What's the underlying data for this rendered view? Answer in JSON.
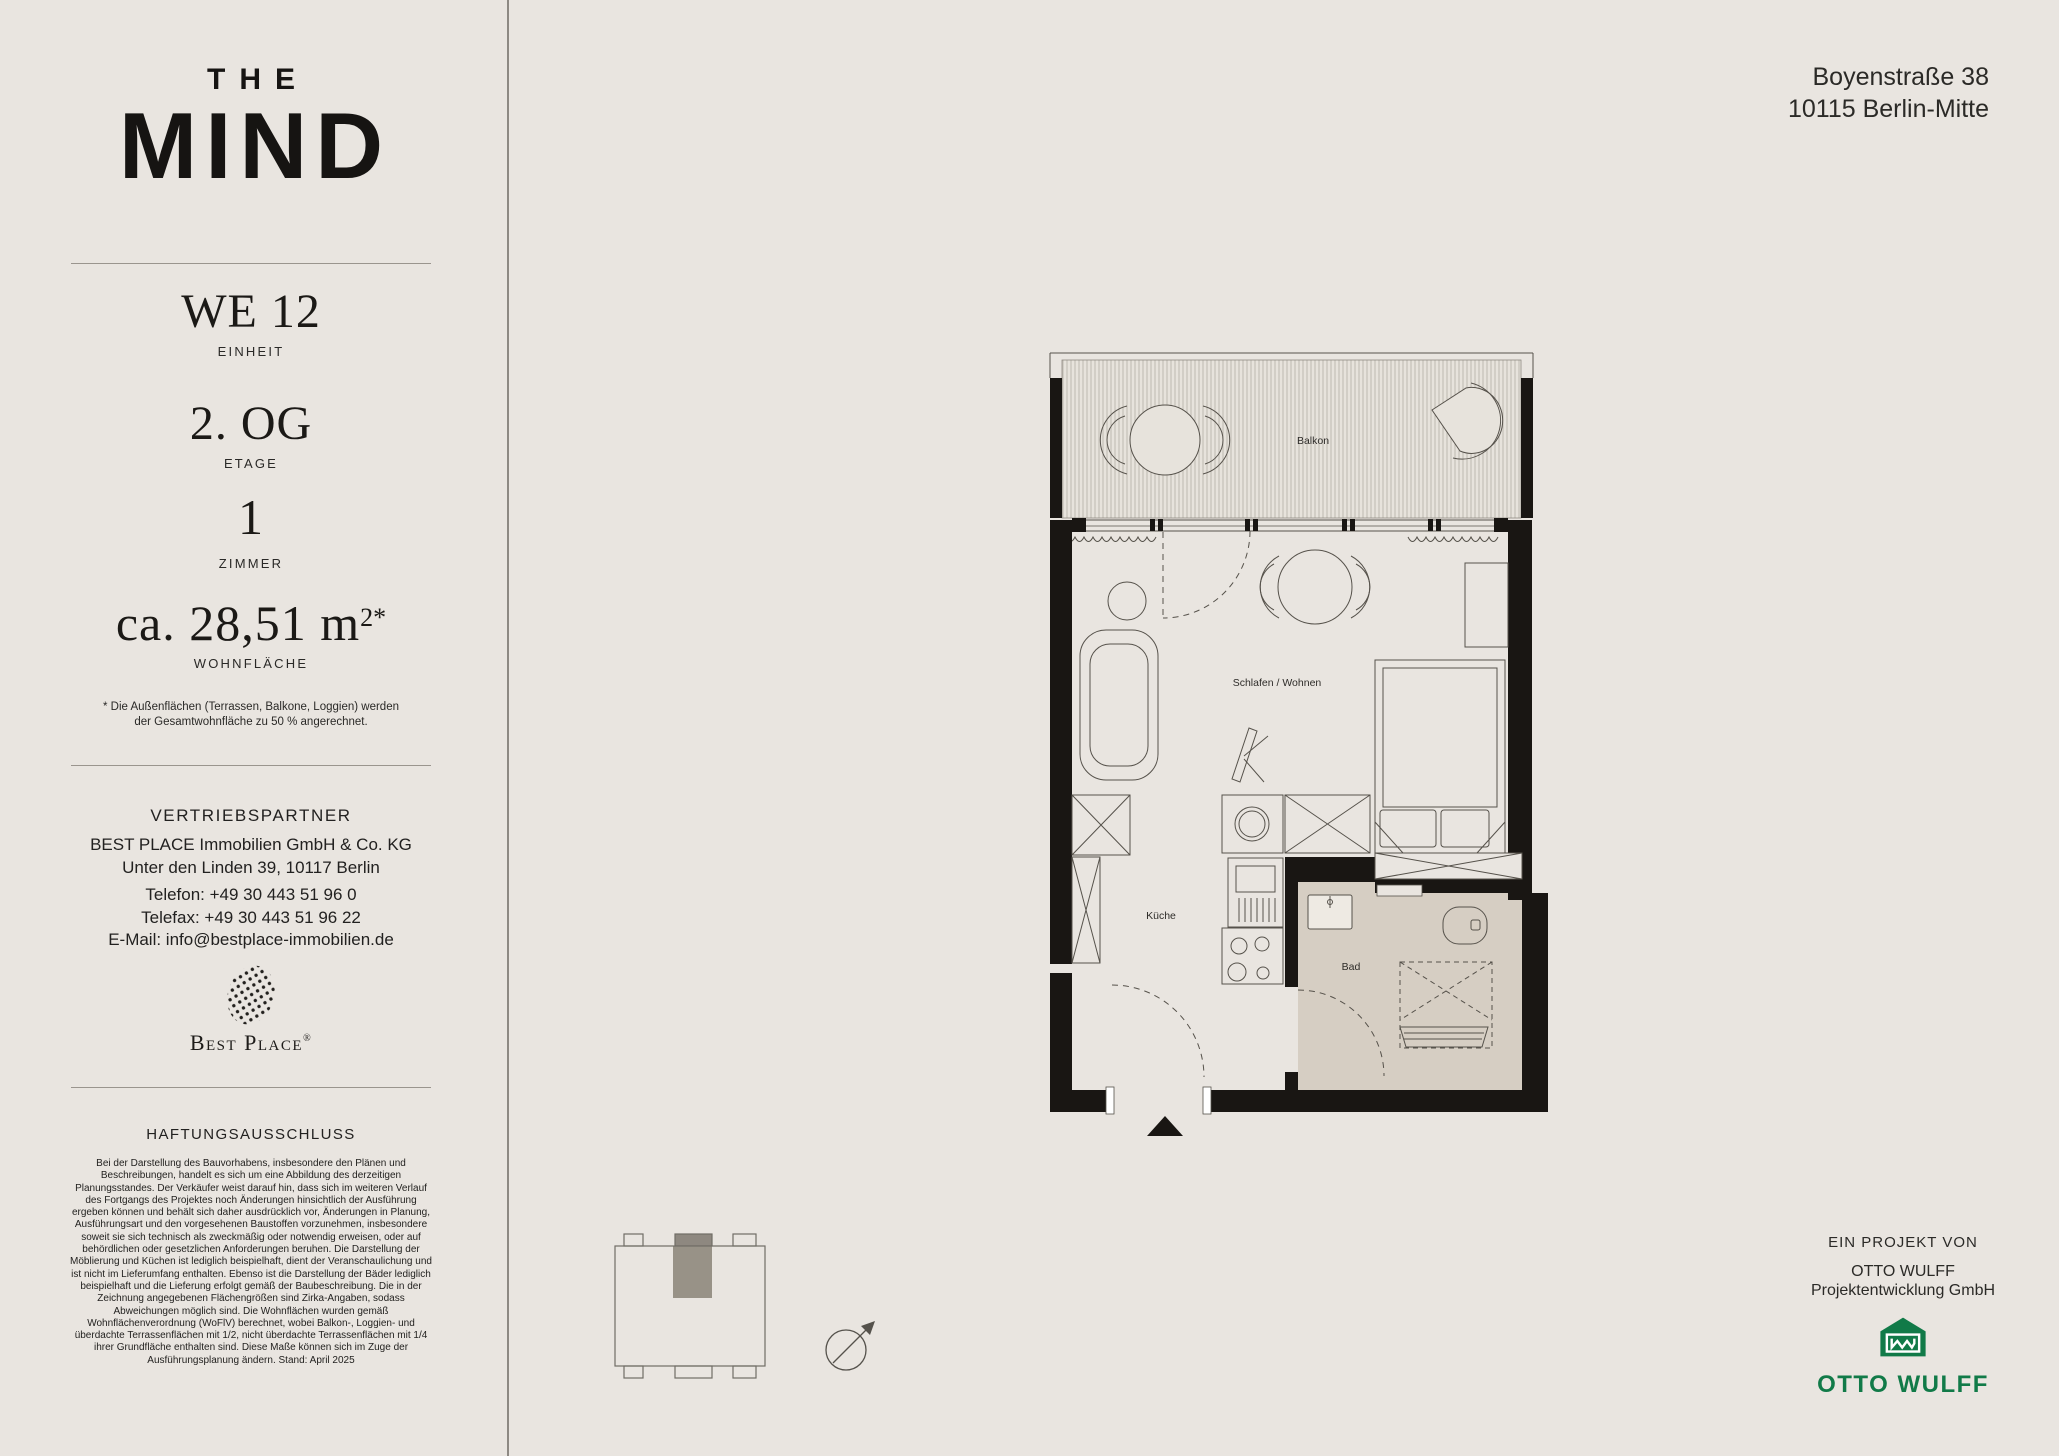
{
  "brand": {
    "line1": "THE",
    "line2": "MIND"
  },
  "sidebar": {
    "unit": {
      "value": "WE 12",
      "label": "EINHEIT"
    },
    "floor": {
      "value": "2. OG",
      "label": "ETAGE"
    },
    "rooms": {
      "value": "1",
      "label": "ZIMMER"
    },
    "area": {
      "value": "ca. 28,51 m",
      "sup": "2*",
      "label": "WOHNFLÄCHE"
    },
    "footnote": "* Die Außenflächen (Terrassen, Balkone, Loggien) werden der Gesamtwohnfläche zu 50 % angerechnet.",
    "partner": {
      "heading": "VERTRIEBSPARTNER",
      "name": "BEST PLACE Immobilien GmbH & Co. KG",
      "address": "Unter den Linden 39, 10117 Berlin",
      "phone": "Telefon: +49 30 443 51 96 0",
      "fax": "Telefax: +49 30 443 51 96 22",
      "email": "E-Mail: info@bestplace-immobilien.de",
      "logo_wordmark": "Best Place",
      "logo_registered": "®"
    },
    "disclaimer": {
      "heading": "HAFTUNGSAUSSCHLUSS",
      "text": "Bei der Darstellung des Bauvorhabens, insbesondere den Plänen und Beschreibungen, handelt es sich um eine Abbildung des derzeitigen Planungsstandes. Der Verkäufer weist darauf hin, dass sich im weiteren Verlauf des Fortgangs des Projektes noch Änderungen hinsichtlich der Ausführung ergeben können und behält sich daher ausdrücklich vor, Änderungen in Planung, Ausführungsart und den vorgesehenen Baustoffen vorzunehmen, insbesondere soweit sie sich technisch als zweckmäßig oder notwendig erweisen, oder auf behördlichen oder gesetzlichen Anforderungen beruhen. Die Darstellung der Möblierung und Küchen ist lediglich beispielhaft, dient der Veranschaulichung und ist nicht im Lieferumfang enthalten. Ebenso ist die Darstellung der Bäder lediglich beispielhaft und die Lieferung erfolgt gemäß der Baubeschreibung. Die in der Zeichnung angegebenen Flächengrößen sind Zirka-Angaben, sodass Abweichungen möglich sind. Die Wohnflächen wurden gemäß Wohnflächenverordnung (WoFlV) berechnet, wobei Balkon-, Loggien- und überdachte Terrassenflächen mit 1/2, nicht überdachte Terrassenflächen mit 1/4 ihrer Grundfläche enthalten sind. Diese Maße können sich im Zuge der Ausführungsplanung ändern. Stand: April 2025"
    }
  },
  "header": {
    "address_line1": "Boyenstraße 38",
    "address_line2": "10115 Berlin-Mitte"
  },
  "project": {
    "heading": "EIN PROJEKT VON",
    "company_line1": "OTTO WULFF",
    "company_line2": "Projektentwicklung GmbH",
    "logo_wordmark": "OTTO WULFF",
    "brand_green": "#117a48"
  },
  "floorplan": {
    "labels": {
      "balcony": "Balkon",
      "living": "Schlafen / Wohnen",
      "kitchen": "Küche",
      "bath": "Bad"
    },
    "colors": {
      "wall": "#191613",
      "line": "#56524b",
      "bath_floor": "#d6cec3",
      "unit_marker": "#8e8880"
    }
  }
}
